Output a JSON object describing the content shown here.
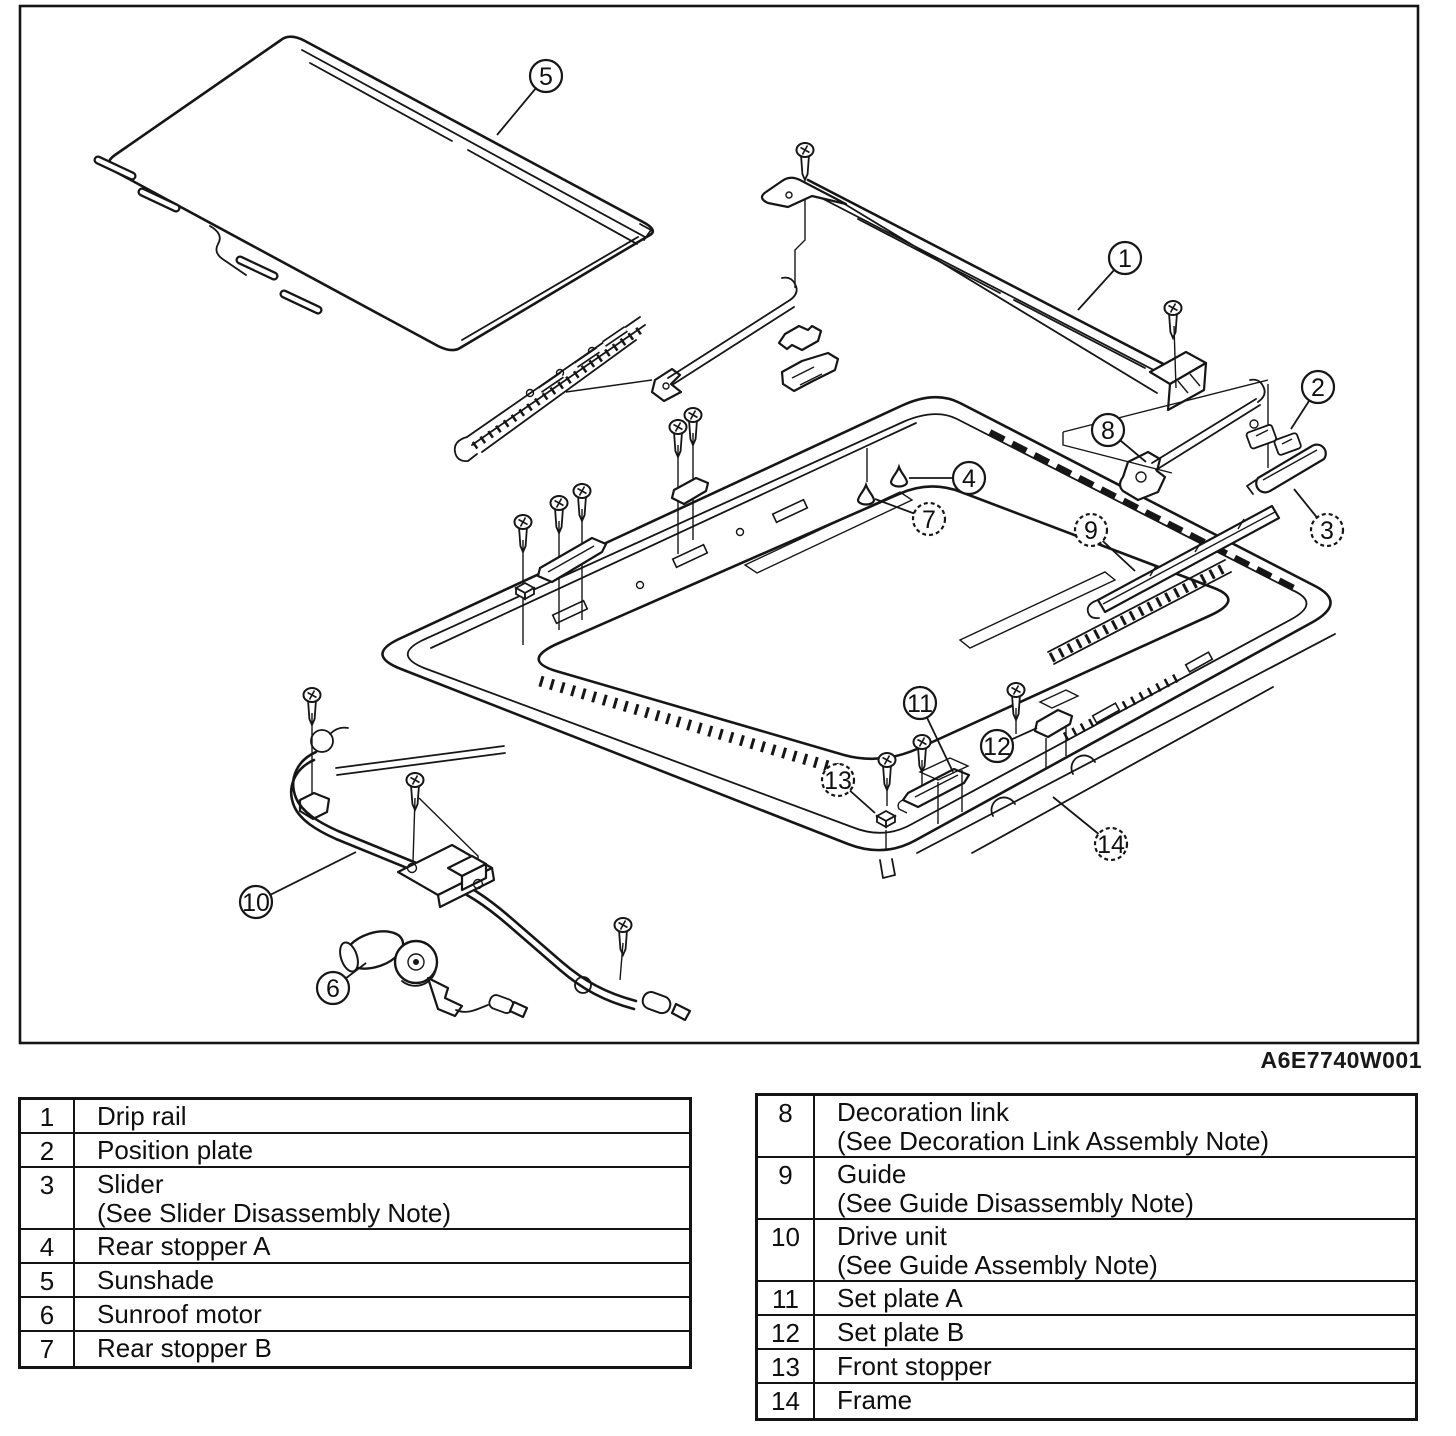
{
  "figure": {
    "ref_code": "A6E7740W001",
    "description": "Sunroof exploded parts diagram"
  },
  "colors": {
    "ink": "#161616",
    "paper": "#ffffff"
  },
  "callouts": [
    {
      "n": "1",
      "part": "drip-rail",
      "cx": 1125,
      "cy": 258,
      "tx": 1078,
      "ty": 310,
      "dashed": false
    },
    {
      "n": "2",
      "part": "position-plate",
      "cx": 1318,
      "cy": 387,
      "tx": 1291,
      "ty": 429,
      "dashed": false
    },
    {
      "n": "3",
      "part": "slider",
      "cx": 1327,
      "cy": 530,
      "tx": 1294,
      "ty": 489,
      "dashed": true
    },
    {
      "n": "4",
      "part": "rear-stopper-a",
      "cx": 969,
      "cy": 478,
      "tx": 909,
      "ty": 478,
      "dashed": false
    },
    {
      "n": "5",
      "part": "sunshade",
      "cx": 546,
      "cy": 76,
      "tx": 497,
      "ty": 135,
      "dashed": false
    },
    {
      "n": "6",
      "part": "sunroof-motor",
      "cx": 333,
      "cy": 988,
      "tx": 366,
      "ty": 963,
      "dashed": false
    },
    {
      "n": "7",
      "part": "rear-stopper-b",
      "cx": 929,
      "cy": 519,
      "tx": 875,
      "ty": 499,
      "dashed": true
    },
    {
      "n": "8",
      "part": "decoration-link",
      "cx": 1108,
      "cy": 430,
      "tx": 1146,
      "ty": 462,
      "dashed": false
    },
    {
      "n": "9",
      "part": "guide",
      "cx": 1091,
      "cy": 530,
      "tx": 1135,
      "ty": 571,
      "dashed": true
    },
    {
      "n": "10",
      "part": "drive-unit",
      "cx": 256,
      "cy": 902,
      "tx": 356,
      "ty": 852,
      "dashed": false
    },
    {
      "n": "11",
      "part": "set-plate-a",
      "cx": 920,
      "cy": 703,
      "tx": 953,
      "ty": 772,
      "dashed": false
    },
    {
      "n": "12",
      "part": "set-plate-b",
      "cx": 997,
      "cy": 746,
      "tx": 1037,
      "ty": 728,
      "dashed": false
    },
    {
      "n": "13",
      "part": "front-stopper",
      "cx": 838,
      "cy": 780,
      "tx": 875,
      "ty": 813,
      "dashed": true
    },
    {
      "n": "14",
      "part": "frame",
      "cx": 1111,
      "cy": 844,
      "tx": 1053,
      "ty": 797,
      "dashed": true
    }
  ],
  "tables": {
    "left": {
      "rows": [
        {
          "num": "1",
          "lines": [
            "Drip rail"
          ]
        },
        {
          "num": "2",
          "lines": [
            "Position plate"
          ]
        },
        {
          "num": "3",
          "lines": [
            "Slider",
            "(See Slider Disassembly Note)"
          ]
        },
        {
          "num": "4",
          "lines": [
            "Rear stopper A"
          ]
        },
        {
          "num": "5",
          "lines": [
            "Sunshade"
          ]
        },
        {
          "num": "6",
          "lines": [
            "Sunroof motor"
          ]
        },
        {
          "num": "7",
          "lines": [
            "Rear stopper B"
          ]
        }
      ]
    },
    "right": {
      "rows": [
        {
          "num": "8",
          "lines": [
            "Decoration link",
            "(See Decoration Link Assembly Note)"
          ]
        },
        {
          "num": "9",
          "lines": [
            "Guide",
            "(See Guide Disassembly Note)"
          ]
        },
        {
          "num": "10",
          "lines": [
            "Drive unit",
            "(See Guide Assembly Note)"
          ]
        },
        {
          "num": "11",
          "lines": [
            "Set plate A"
          ]
        },
        {
          "num": "12",
          "lines": [
            "Set plate B"
          ]
        },
        {
          "num": "13",
          "lines": [
            "Front stopper"
          ]
        },
        {
          "num": "14",
          "lines": [
            "Frame"
          ]
        }
      ]
    }
  }
}
